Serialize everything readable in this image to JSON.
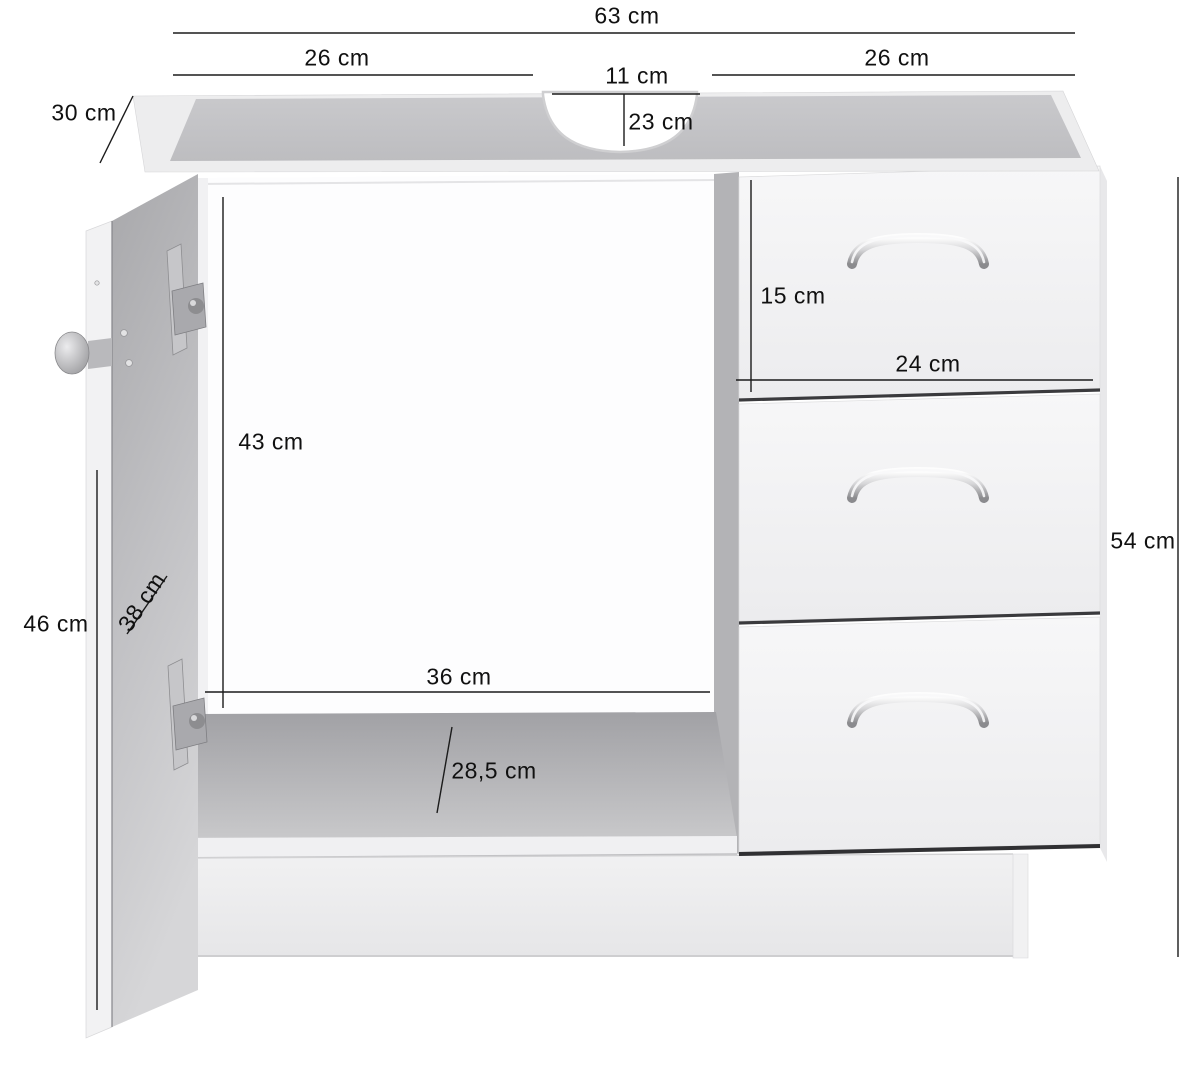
{
  "diagram_type": "furniture-dimension-diagram",
  "dimensions": {
    "total_width": "63 cm",
    "top_left_width": "26 cm",
    "cutout_width": "11 cm",
    "top_right_width": "26 cm",
    "depth": "30 cm",
    "cutout_depth": "23 cm",
    "drawer_height": "15 cm",
    "drawer_width": "24 cm",
    "interior_height": "43 cm",
    "door_diagonal": "38 cm",
    "door_height": "46 cm",
    "interior_width": "36 cm",
    "base_depth": "28,5 cm",
    "cabinet_height": "54 cm"
  },
  "colors": {
    "dimension_line": "#1b1b1b",
    "label_text": "#101010",
    "background": "#ffffff",
    "cabinet_white": "#f2f2f3",
    "cabinet_gray": "#b5b5b8",
    "handle_silver": "#c9c9cb"
  }
}
